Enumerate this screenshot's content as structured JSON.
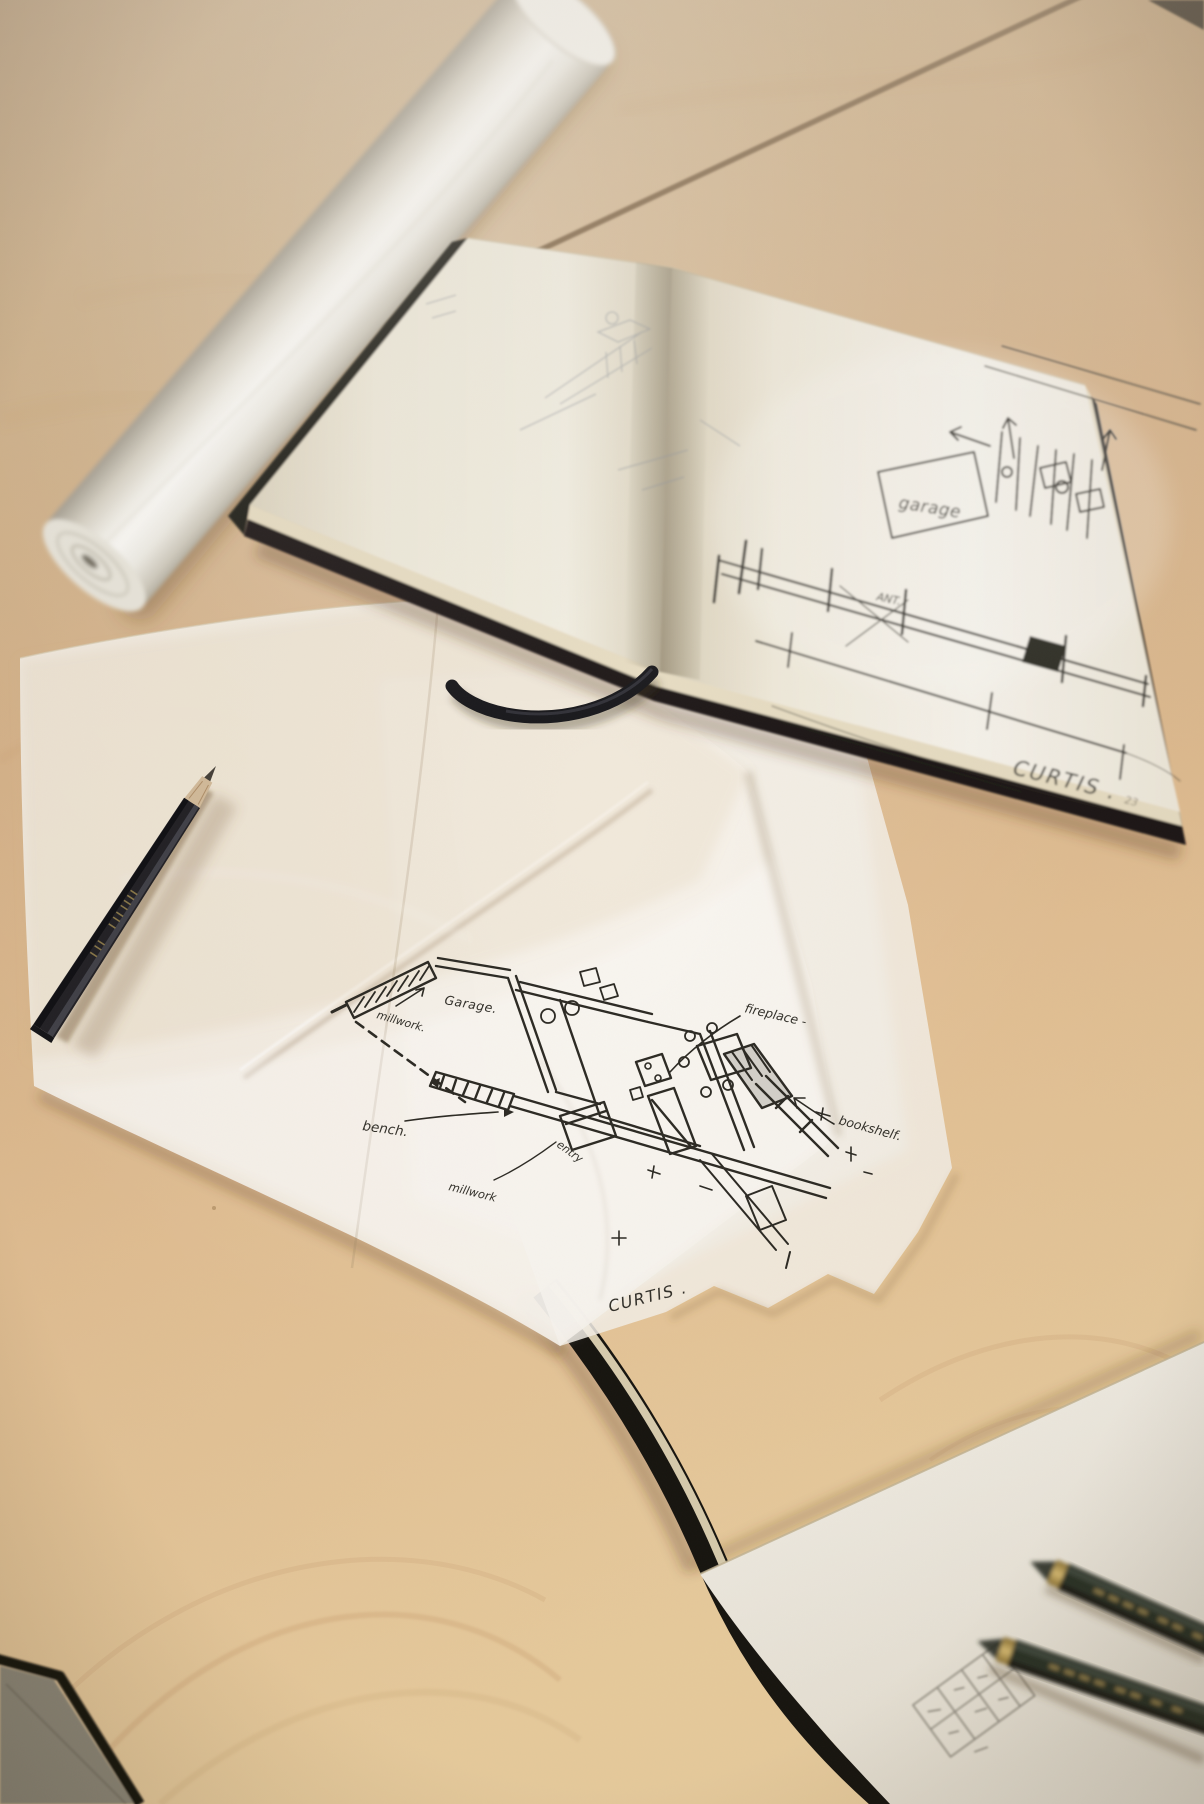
{
  "scene": {
    "description": "Architect's hand sketches spread on a light birch table: an open black sketchbook with pen concept sketches, a sheet of tracing paper with an ink floor plan, a rolled sheet of white paper, and drawing pencils",
    "objects": {
      "paper_roll": "rolled sheet of white paper",
      "sketchbook": "open black sketchbook",
      "ribbon": "black ribbon bookmark",
      "tracing_paper": "tracing paper with ink floor plan",
      "graphite_pencil": "black graphite pencil",
      "lower_sketchbook": "second sketchbook beneath tracing paper",
      "green_pencils": "two dark-green artist pencils",
      "grey_folder": "grey folder corner"
    },
    "colors": {
      "wood": "#d7b288",
      "page_white": "#f6f3ec",
      "tracing_paper": "#f4f0e7",
      "ink": "#35332d",
      "cover_black": "#1b1916",
      "pencil_gold": "#c0a362"
    }
  },
  "sketchbook_page": {
    "garage_label": "garage",
    "attic_note": "ANT.",
    "signature": "CURTIS .",
    "page_number": "23"
  },
  "floor_plan": {
    "garage_label": "Garage.",
    "millwork_label_top": "millwork.",
    "fireplace_label": "fireplace -",
    "bookshelf_label": "bookshelf.",
    "bench_label": "bench.",
    "entry_label": "entry",
    "millwork_label_bottom": "millwork",
    "signature": "CURTIS ."
  }
}
